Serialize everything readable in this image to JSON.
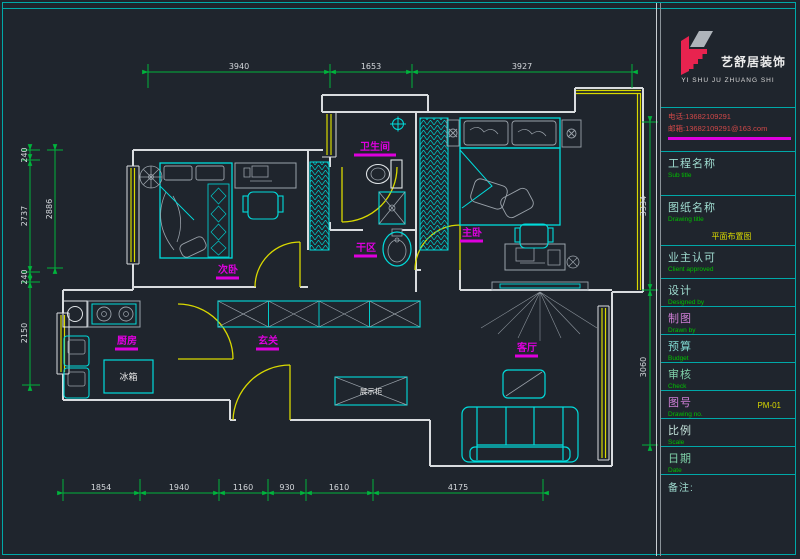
{
  "logo": {
    "company_cn": "艺舒居装饰",
    "company_en": "YI SHU JU ZHUANG SHI"
  },
  "contact": {
    "phone": "电话:13682109291",
    "email": "邮箱:13682109291@163.com"
  },
  "titleblock": {
    "rows": [
      {
        "cn": "工程名称",
        "en": "Sub title",
        "value": ""
      },
      {
        "cn": "图纸名称",
        "en": "Drawing title",
        "value": "平面布置图"
      },
      {
        "cn": "业主认可",
        "en": "Client approved",
        "value": ""
      },
      {
        "cn": "设计",
        "en": "Designed by",
        "value": ""
      },
      {
        "cn": "制图",
        "en": "Drawn by",
        "value": ""
      },
      {
        "cn": "预算",
        "en": "Budget",
        "value": ""
      },
      {
        "cn": "审核",
        "en": "Check",
        "value": ""
      },
      {
        "cn": "图号",
        "en": "Drawing no.",
        "value": "PM-01"
      },
      {
        "cn": "比例",
        "en": "Scale",
        "value": ""
      },
      {
        "cn": "日期",
        "en": "Date",
        "value": ""
      }
    ],
    "note_label": "备注:"
  },
  "rooms": {
    "bathroom": "卫生间",
    "dry_area": "干区",
    "master_bedroom": "主卧",
    "second_bedroom": "次卧",
    "kitchen": "厨房",
    "entry": "玄关",
    "living_room": "客厅"
  },
  "fixtures": {
    "fridge": "冰箱",
    "display_cabinet": "展示柜"
  },
  "dims": {
    "top": [
      "3940",
      "1653",
      "3927"
    ],
    "bottom": [
      "1854",
      "1940",
      "1160",
      "930",
      "1610",
      "4175"
    ],
    "left": [
      "240",
      "2886",
      "2737",
      "240",
      "2150"
    ],
    "right": [
      "3334",
      "3060"
    ]
  },
  "colors": {
    "background": "#1f252d",
    "wall": "#d9dcdf",
    "furniture_cyan": "#00dcdc",
    "dimension_green": "#00b43c",
    "door_window_yellow": "#d9d900",
    "label_magenta": "#dd00dd",
    "border_teal": "#00a8a8",
    "logo_red": "#e8234f",
    "contact_red": "#d04848",
    "en_text_green": "#00c000",
    "value_yellow": "#d9d900"
  }
}
